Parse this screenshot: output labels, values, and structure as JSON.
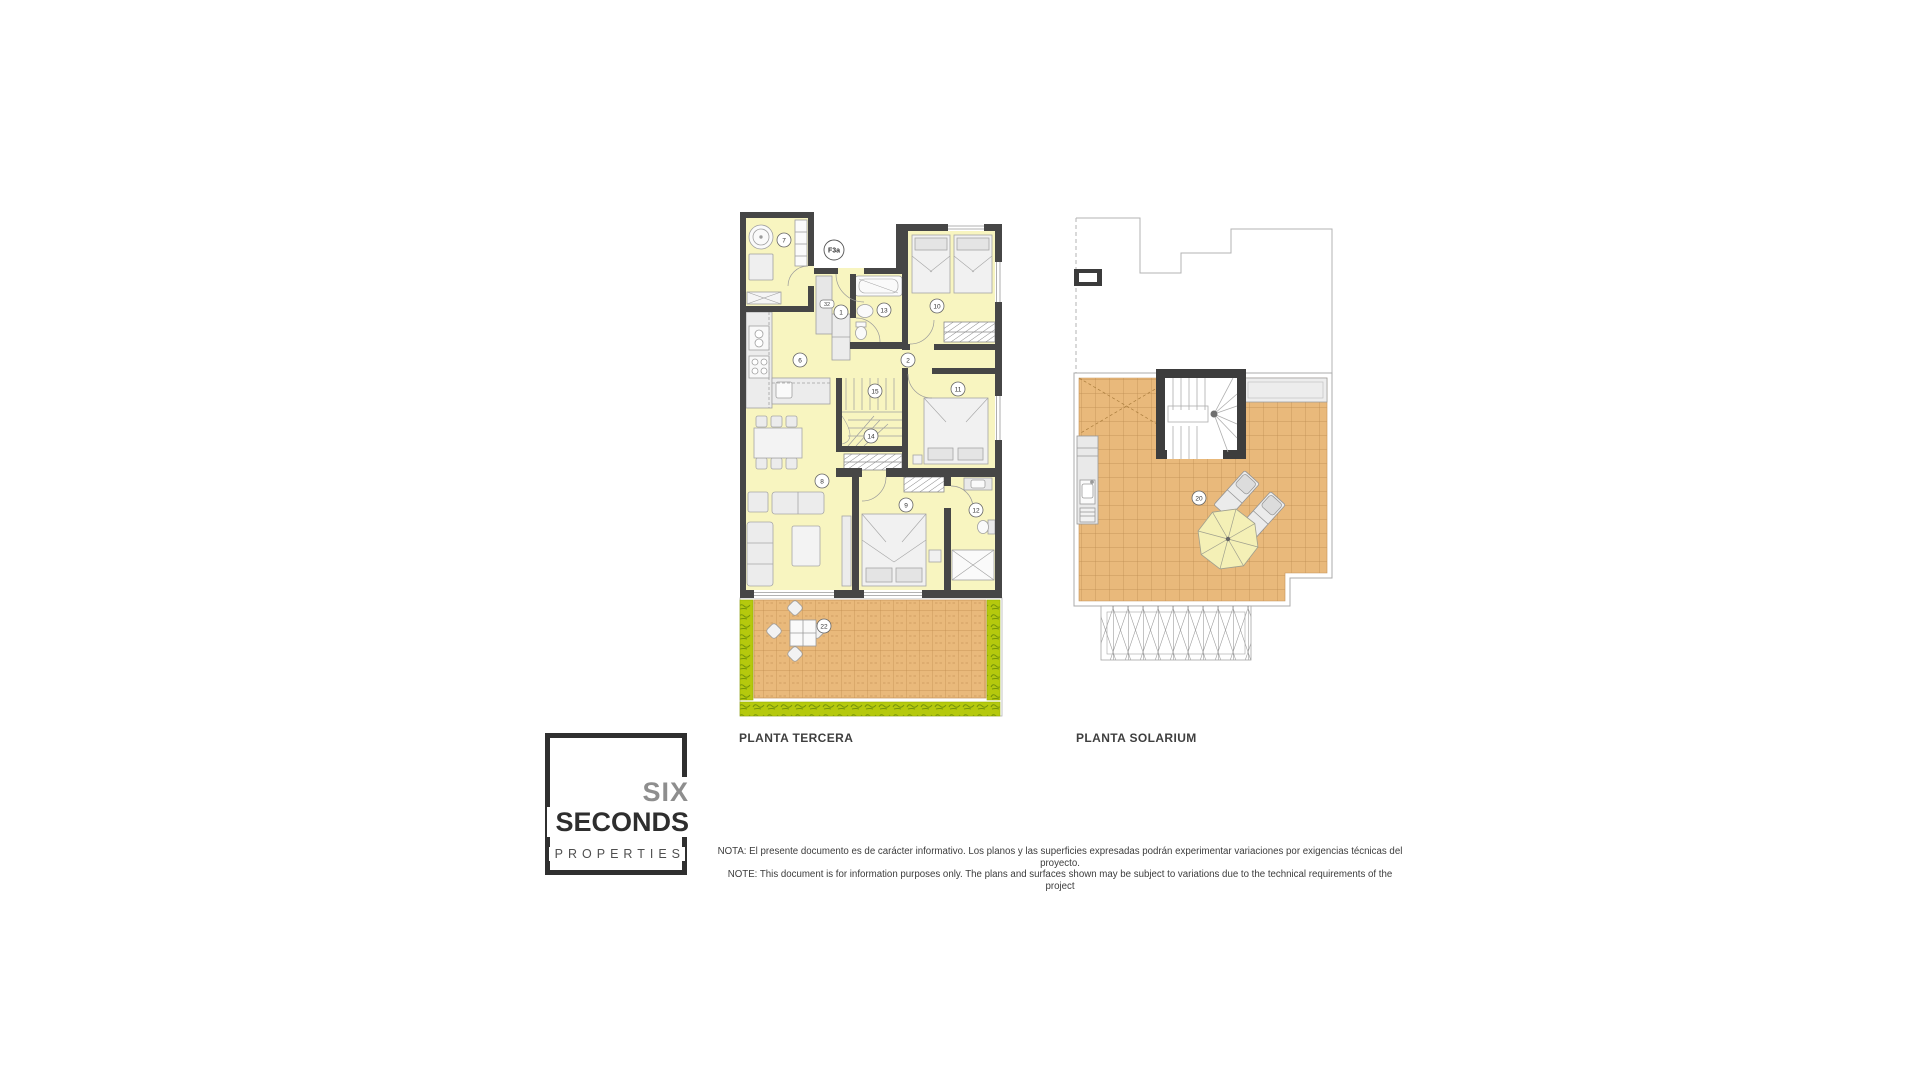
{
  "plans": {
    "tercera": {
      "title": "PLANTA TERCERA",
      "unit_label": "F3a",
      "rooms": [
        {
          "num": "7",
          "name": "laundry"
        },
        {
          "num": "32",
          "name": "utility-shaft"
        },
        {
          "num": "1",
          "name": "entrance-hall"
        },
        {
          "num": "13",
          "name": "bathroom-1"
        },
        {
          "num": "10",
          "name": "bedroom-2"
        },
        {
          "num": "2",
          "name": "corridor"
        },
        {
          "num": "15",
          "name": "stairs-upper"
        },
        {
          "num": "11",
          "name": "bedroom-3"
        },
        {
          "num": "14",
          "name": "stairs-lower"
        },
        {
          "num": "6",
          "name": "kitchen"
        },
        {
          "num": "8",
          "name": "living-dining"
        },
        {
          "num": "9",
          "name": "master-bedroom"
        },
        {
          "num": "12",
          "name": "bathroom-2"
        },
        {
          "num": "22",
          "name": "terrace"
        }
      ]
    },
    "solarium": {
      "title": "PLANTA SOLARIUM",
      "rooms": [
        {
          "num": "20",
          "name": "solarium-terrace"
        }
      ]
    }
  },
  "logo": {
    "line1": "SIX",
    "line2": "SECONDS",
    "line3": "PROPERTIES"
  },
  "note": {
    "line1": "NOTA: El presente documento es de carácter informativo. Los planos y las superficies expresadas podrán experimentar variaciones por exigencias técnicas del proyecto.",
    "line2": "NOTE: This document is for information purposes only. The plans and surfaces shown may be subject to variations due to the technical requirements of the project"
  },
  "colors": {
    "wall": "#464646",
    "room_fill": "#F8F5C0",
    "tile": "#E9B97B",
    "tile_line": "#BC8C50",
    "hedge": "#B5C90D",
    "furniture": "#ECECEC"
  }
}
